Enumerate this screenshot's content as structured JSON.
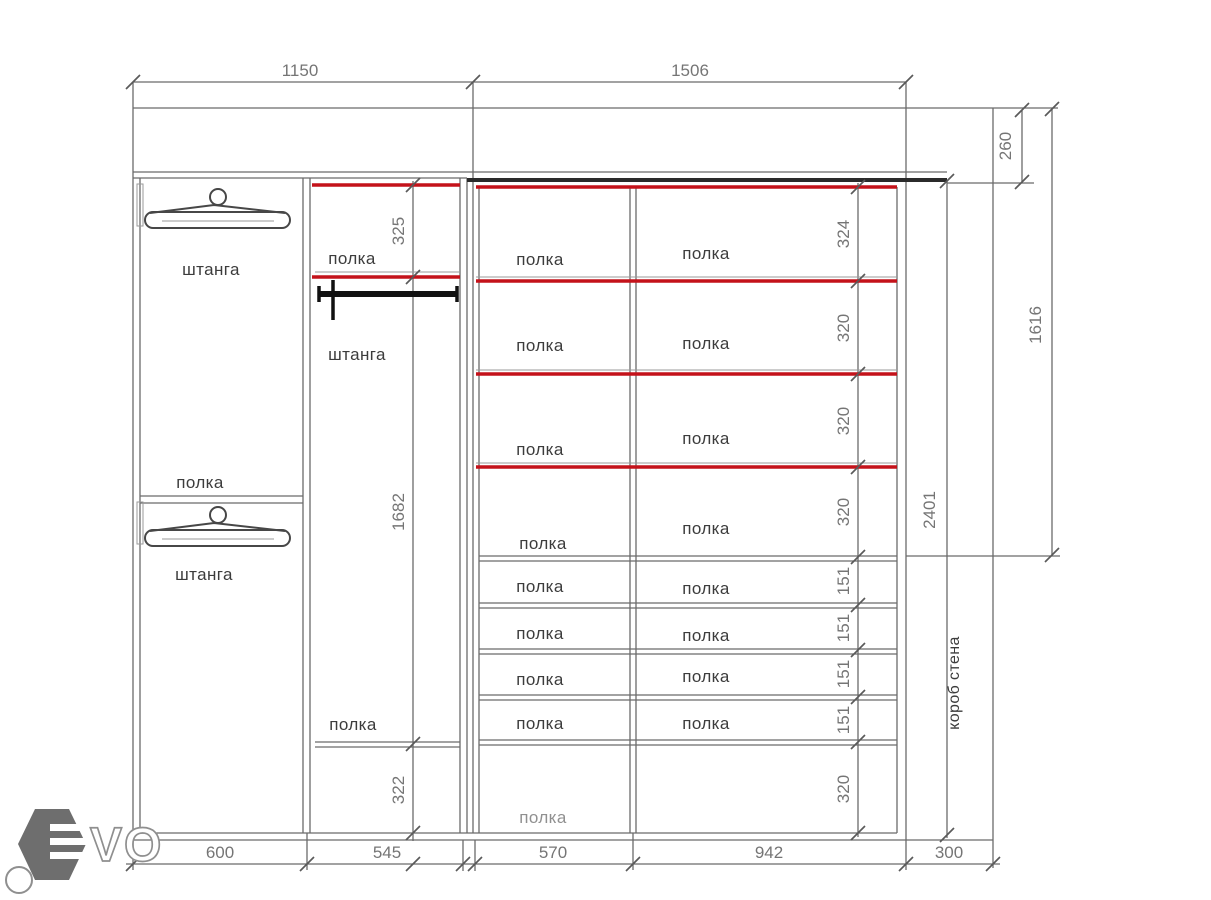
{
  "drawing_type": "wardrobe interior elevation",
  "units_implied": "mm",
  "colors": {
    "structure_line": "#6b6b6b",
    "shelf_highlight_red": "#c4121a",
    "rod_black": "#111111",
    "dim_text": "#757575",
    "label_text": "#3c3c3c",
    "faded_label_text": "#909090",
    "logo_gray": "#6e6e6e"
  },
  "dims": {
    "top": [
      "1150",
      "1506"
    ],
    "bottom": [
      "600",
      "545",
      "570",
      "942",
      "300"
    ],
    "right": [
      "260",
      "1616",
      "2401"
    ],
    "middle_column": [
      "325",
      "1682",
      "322"
    ],
    "shelf_rows": [
      "324",
      "320",
      "320",
      "320",
      "151",
      "151",
      "151",
      "151",
      "320"
    ]
  },
  "sections": {
    "left": {
      "rod_top": "штанга",
      "shelf": "полка",
      "rod_bottom": "штанга"
    },
    "middle": {
      "shelf_top": "полка",
      "rod": "штанга",
      "shelf_bottom": "полка"
    },
    "col570_shelves": [
      "полка",
      "полка",
      "полка",
      "полка",
      "полка",
      "полка",
      "полка",
      "полка",
      "полка"
    ],
    "col942_shelves": [
      "полка",
      "полка",
      "полка",
      "полка",
      "полка",
      "полка",
      "полка",
      "полка"
    ],
    "wall_box": "короб стена"
  },
  "logo": {
    "letters": "VO"
  }
}
